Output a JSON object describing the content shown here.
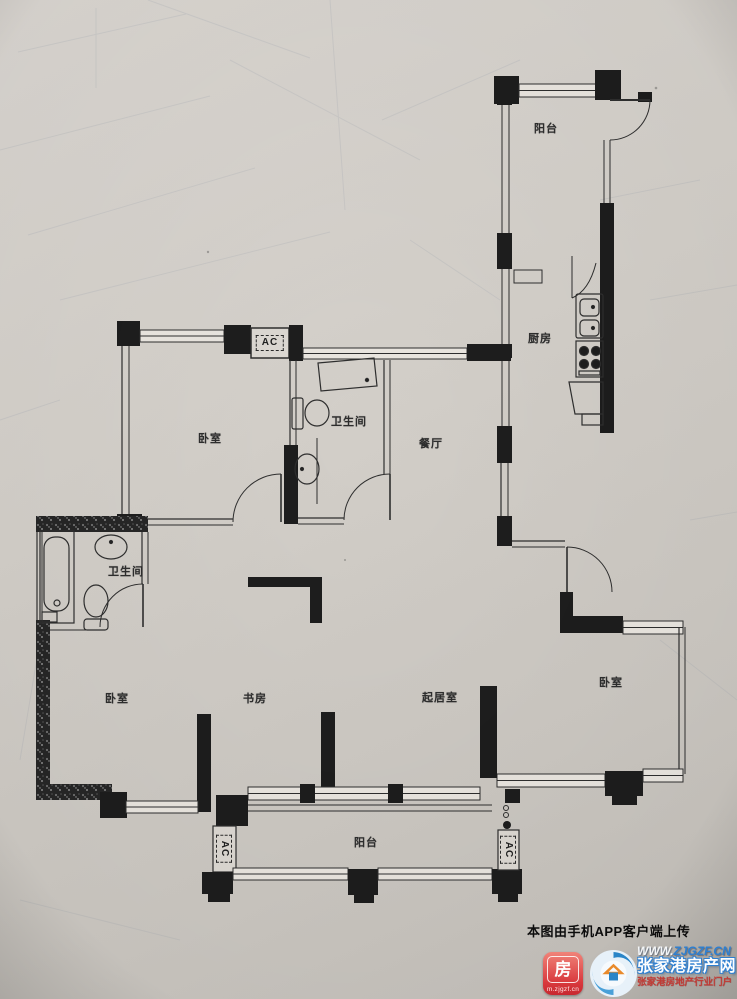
{
  "colors": {
    "paper": "#d4d0ca",
    "ink": "#1d1d1d",
    "brand_red": "#d8403f",
    "brand_blue": "#2e7fd0"
  },
  "rooms": [
    {
      "id": "balcony-top",
      "label": "阳台"
    },
    {
      "id": "kitchen",
      "label": "厨房"
    },
    {
      "id": "bathroom-middle",
      "label": "卫生间"
    },
    {
      "id": "bedroom-top-left",
      "label": "卧室"
    },
    {
      "id": "dining-room",
      "label": "餐厅"
    },
    {
      "id": "bathroom-left",
      "label": "卫生间"
    },
    {
      "id": "bedroom-left",
      "label": "卧室"
    },
    {
      "id": "study",
      "label": "书房"
    },
    {
      "id": "living-room",
      "label": "起居室"
    },
    {
      "id": "bedroom-right",
      "label": "卧室"
    },
    {
      "id": "balcony-bottom",
      "label": "阳台"
    }
  ],
  "ac_units": [
    {
      "id": "ac-top",
      "label": "AC"
    },
    {
      "id": "ac-bottom-left",
      "label": "AC"
    },
    {
      "id": "ac-bottom-right",
      "label": "AC"
    }
  ],
  "watermark": {
    "upload_note": "本图由手机APP客户端上传",
    "app_badge_char": "房",
    "app_badge_caption": "m.zjgzf.cn",
    "site_url_www": "WWW.",
    "site_url_domain": "ZJGZF.CN",
    "site_name": "张家港房产网",
    "site_tagline": "张家港房地产行业门户"
  }
}
